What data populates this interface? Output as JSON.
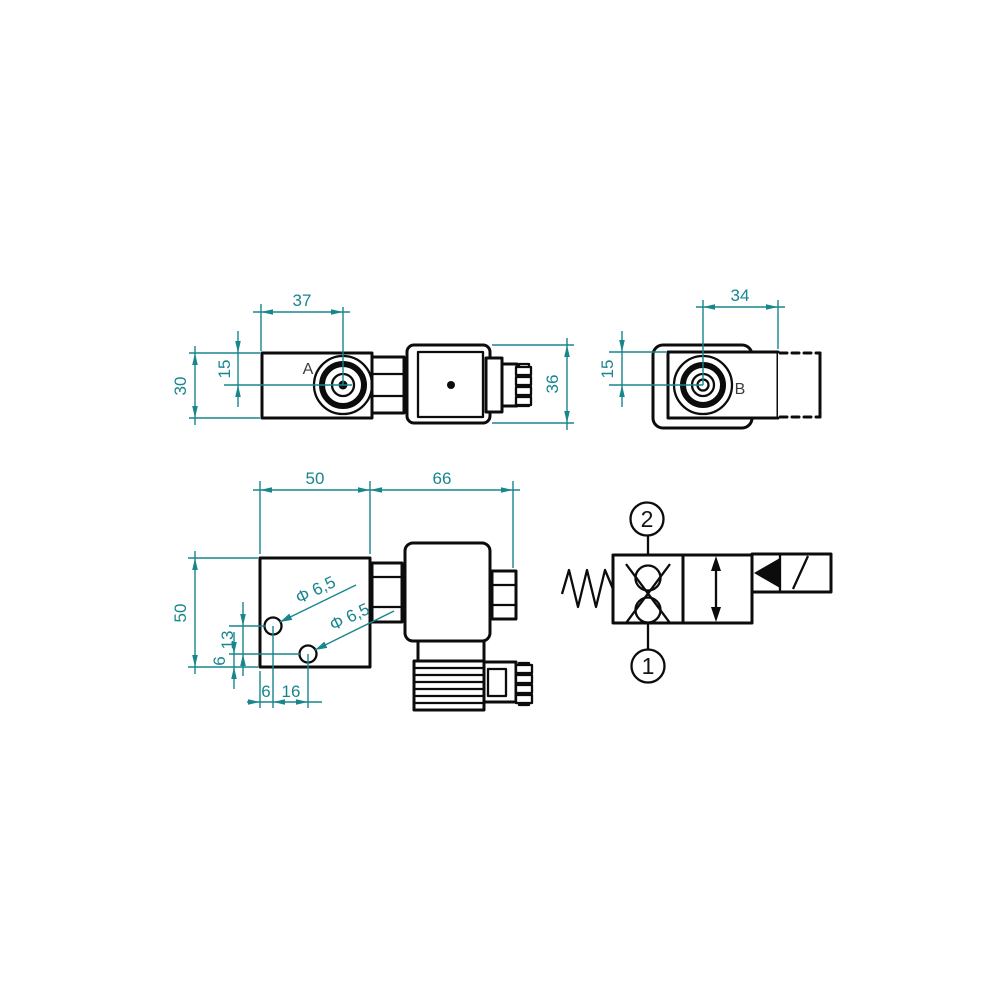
{
  "colors": {
    "outline": "#0c0c0c",
    "dimension": "#17868d",
    "background": "#ffffff"
  },
  "view_a": {
    "label": "A",
    "width": "37",
    "center_offset": "15",
    "height": "30",
    "solenoid_height": "36"
  },
  "view_b": {
    "label": "B",
    "width": "34",
    "center_offset": "15"
  },
  "view_front": {
    "width": "50",
    "solenoid_length": "66",
    "height": "50",
    "hole1_diameter": "Φ 6,5",
    "hole2_diameter": "Φ 6,5",
    "holes_vertical_spacing": "13",
    "hole_bottom_offset": "6",
    "hole_left_offset": "6",
    "holes_horizontal_spacing": "16"
  },
  "schematic": {
    "port_top": "2",
    "port_bottom": "1"
  }
}
